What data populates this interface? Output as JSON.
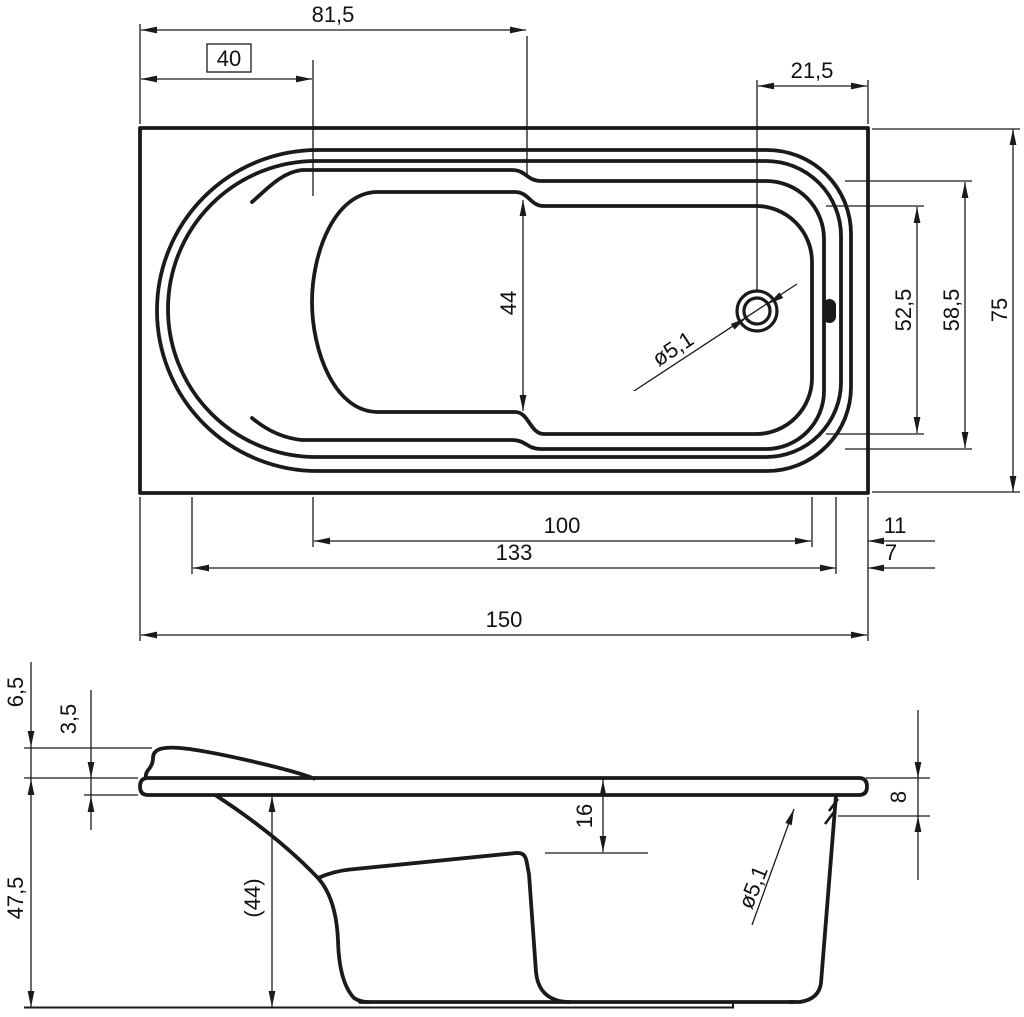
{
  "colors": {
    "line": "#1a1a1a",
    "background": "#ffffff"
  },
  "top_view": {
    "rim_top_length": "81,5",
    "seat_length_boxed": "40",
    "drain_from_right": "21,5",
    "floor_width": "44",
    "drain_diameter": "ø5,1",
    "inner_width_right": "52,5",
    "opening_width_right": "58,5",
    "overall_width": "75",
    "floor_length": "100",
    "floor_to_edge": "11",
    "inner_length": "133",
    "inner_to_edge": "7",
    "overall_length": "150"
  },
  "side_view": {
    "headrest_height": "6,5",
    "rim_thickness": "3,5",
    "total_height": "47,5",
    "height_under_rim": "(44)",
    "seat_depth": "16",
    "overflow_from_top": "8",
    "overflow_diameter": "ø5,1"
  }
}
